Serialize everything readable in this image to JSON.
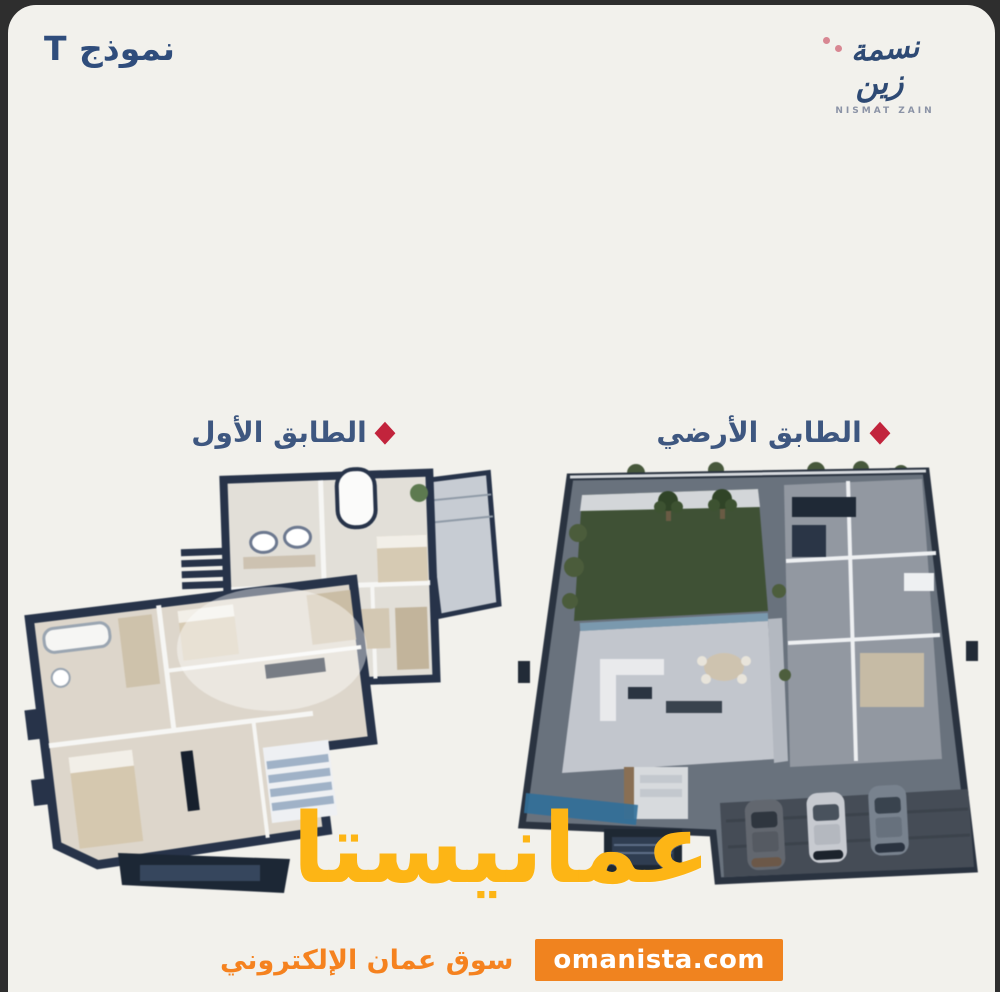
{
  "header": {
    "model_label": "نموذج T"
  },
  "logo": {
    "arabic_word1": "نسمة",
    "arabic_word2": "زين",
    "latin": "NISMAT ZAIN"
  },
  "floors": {
    "first": {
      "label": "الطابق الأول",
      "marker": "◆"
    },
    "ground": {
      "label": "الطابق الأرضي",
      "marker": "◆"
    }
  },
  "watermark": {
    "brand": "عمانيستا",
    "tagline": "سوق عمان الإلكتروني",
    "domain": "omanista.com"
  },
  "colors": {
    "card_background": "#f2f1ec",
    "navy_text": "#2f4d7c",
    "floor_label_text": "#3e5780",
    "diamond_red": "#c2243c",
    "brand_yellow": "#fdb515",
    "accent_orange": "#f0831f",
    "plan_wall_navy": "#26334a",
    "lawn_green": "#3e5134"
  }
}
